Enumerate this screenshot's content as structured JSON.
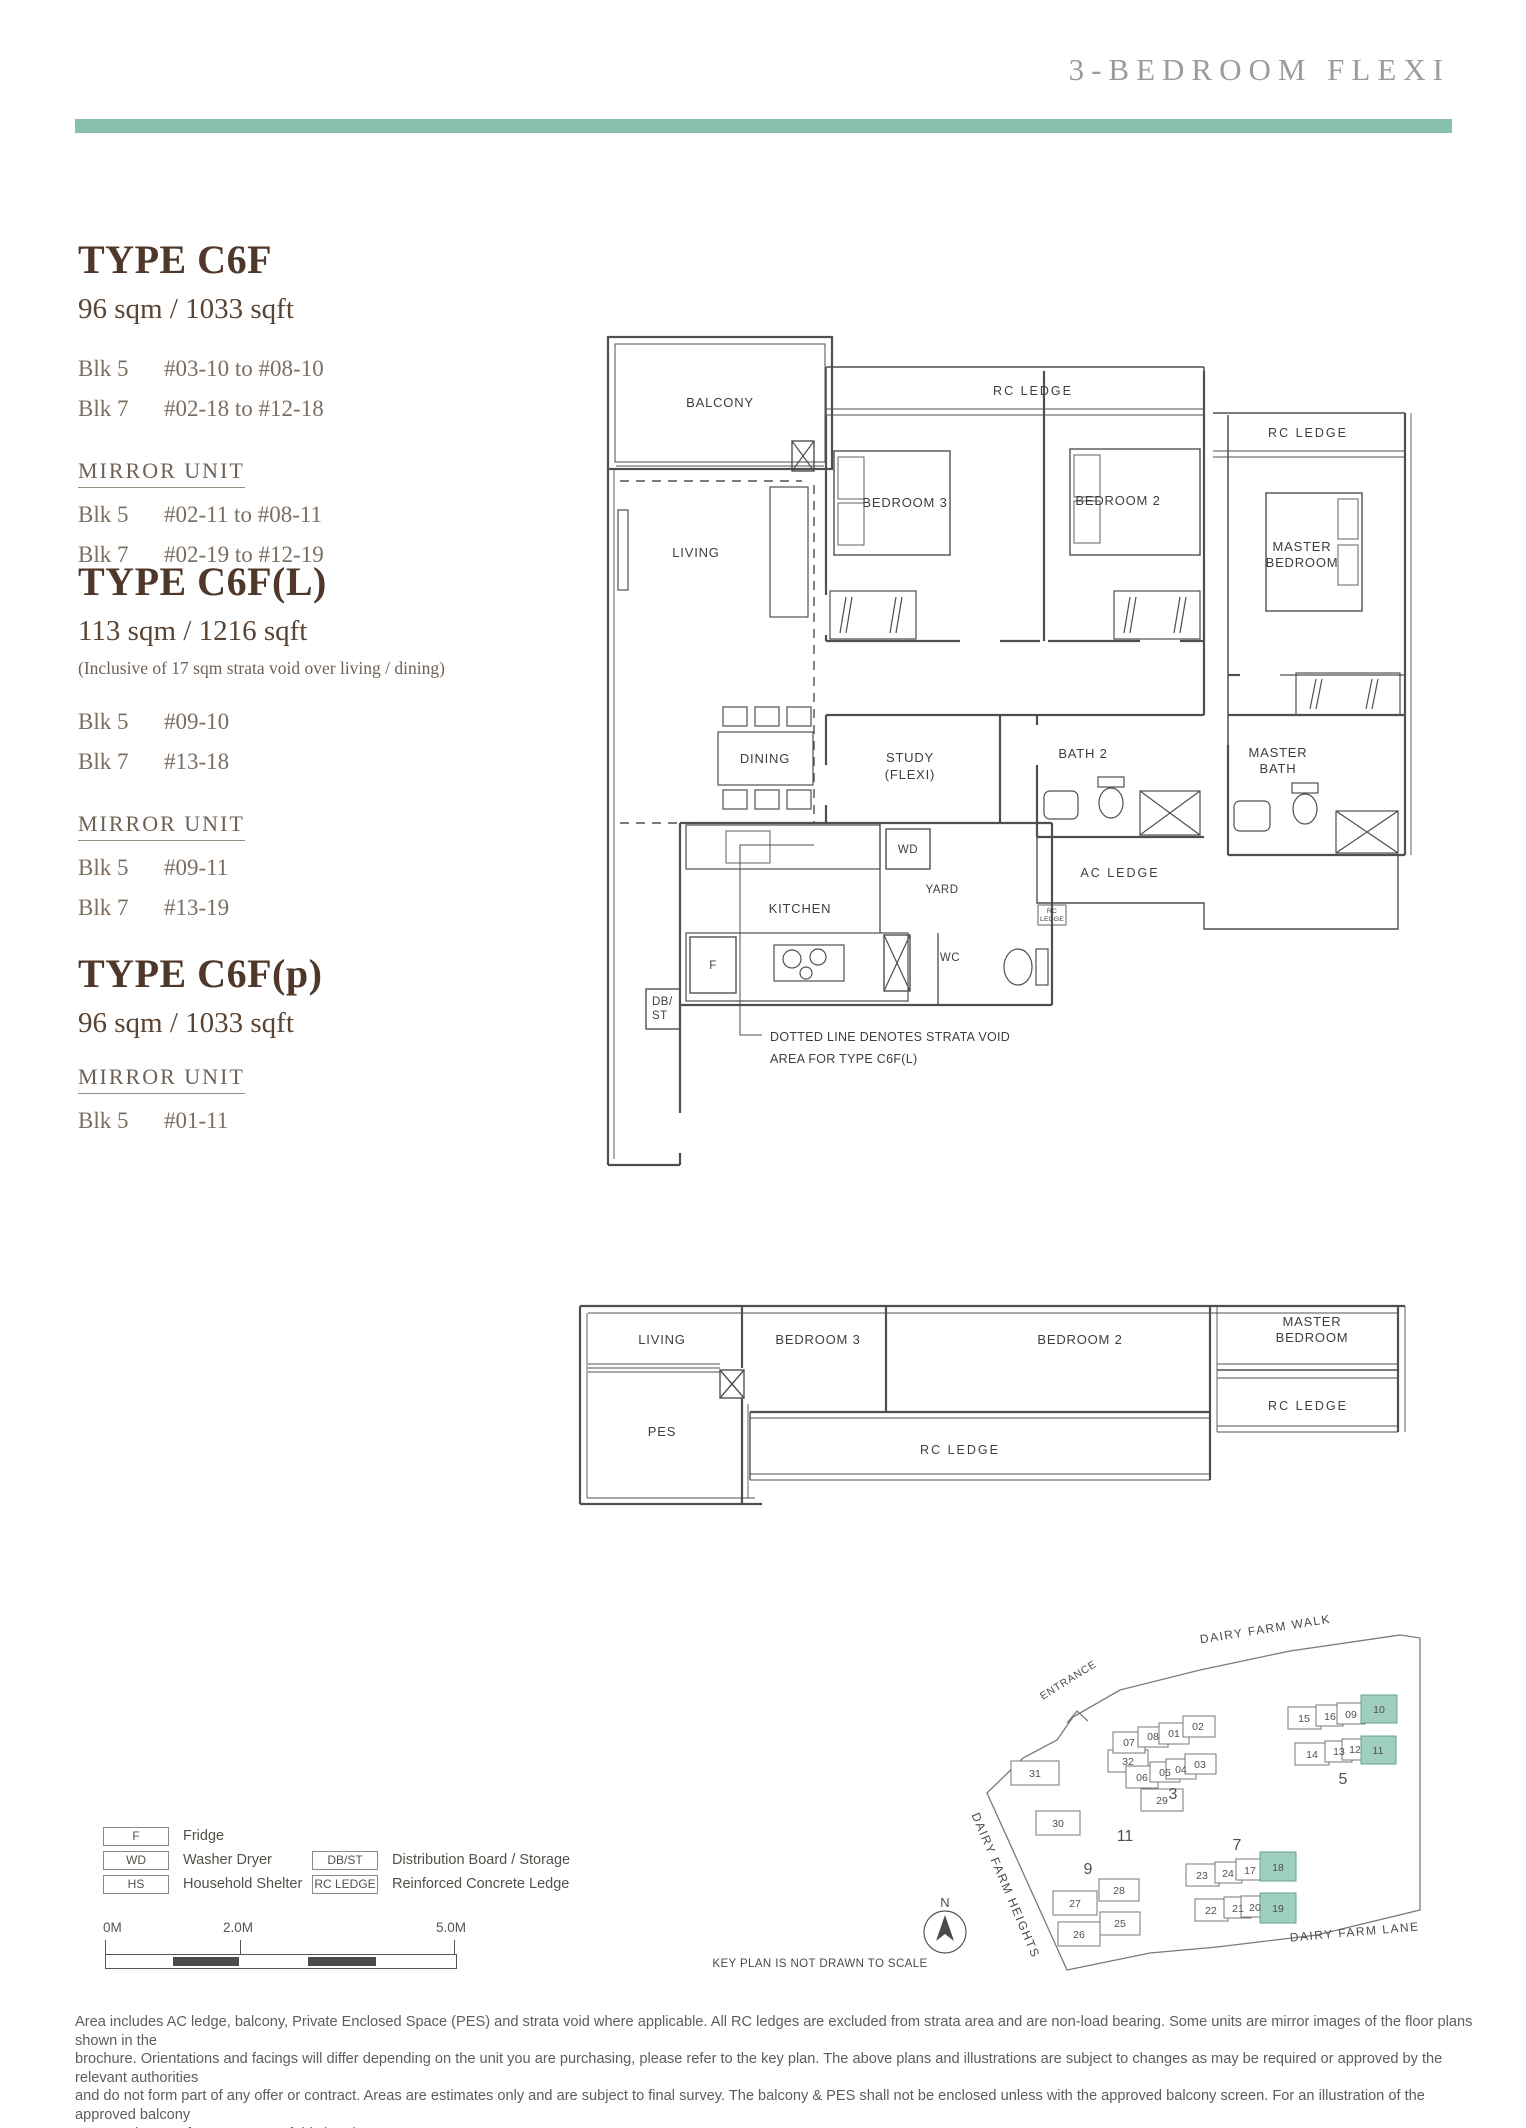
{
  "header": {
    "title": "3-BEDROOM FLEXI"
  },
  "accent_color": "#87c1ac",
  "types": [
    {
      "name": "TYPE C6F",
      "area": "96 sqm / 1033 sqft",
      "note": "",
      "units": [
        {
          "blk": "Blk 5",
          "range": "#03-10 to #08-10"
        },
        {
          "blk": "Blk 7",
          "range": "#02-18 to #12-18"
        }
      ],
      "mirror_label": "MIRROR UNIT",
      "mirror_units": [
        {
          "blk": "Blk 5",
          "range": "#02-11 to #08-11"
        },
        {
          "blk": "Blk 7",
          "range": "#02-19 to #12-19"
        }
      ]
    },
    {
      "name": "TYPE C6F(L)",
      "area": "113 sqm / 1216 sqft",
      "note": "(Inclusive of 17 sqm strata void over living / dining)",
      "units": [
        {
          "blk": "Blk 5",
          "range": "#09-10"
        },
        {
          "blk": "Blk 7",
          "range": "#13-18"
        }
      ],
      "mirror_label": "MIRROR UNIT",
      "mirror_units": [
        {
          "blk": "Blk 5",
          "range": "#09-11"
        },
        {
          "blk": "Blk 7",
          "range": "#13-19"
        }
      ]
    },
    {
      "name": "TYPE C6F(p)",
      "area": "96 sqm / 1033 sqft",
      "note": "",
      "units": [],
      "mirror_label": "MIRROR UNIT",
      "mirror_units": [
        {
          "blk": "Blk 5",
          "range": "#01-11"
        }
      ]
    }
  ],
  "plan1": {
    "balcony": "BALCONY",
    "living": "LIVING",
    "dining": "DINING",
    "study1": "STUDY",
    "study2": "(FLEXI)",
    "kitchen": "KITCHEN",
    "yard": "YARD",
    "wc": "WC",
    "wd": "WD",
    "fridge": "F",
    "dbst1": "DB/",
    "dbst2": "ST",
    "bedroom3": "BEDROOM 3",
    "bedroom2": "BEDROOM 2",
    "master1": "MASTER",
    "master2": "BEDROOM",
    "bath2": "BATH 2",
    "mbath1": "MASTER",
    "mbath2": "BATH",
    "rc_ledge1": "RC LEDGE",
    "rc_ledge2": "RC LEDGE",
    "rc_small1": "RC",
    "rc_small2": "LEDGE",
    "ac_ledge": "AC LEDGE",
    "note1": "DOTTED LINE DENOTES STRATA VOID",
    "note2": "AREA FOR TYPE C6F(L)"
  },
  "plan2": {
    "living": "LIVING",
    "pes": "PES",
    "bedroom3": "BEDROOM 3",
    "bedroom2": "BEDROOM 2",
    "master1": "MASTER",
    "master2": "BEDROOM",
    "rc_ledge1": "RC LEDGE",
    "rc_ledge2": "RC LEDGE"
  },
  "legend": {
    "items": [
      {
        "code": "F",
        "desc": "Fridge"
      },
      {
        "code": "WD",
        "desc": "Washer Dryer"
      },
      {
        "code": "HS",
        "desc": "Household Shelter"
      },
      {
        "code": "DB/ST",
        "desc": "Distribution Board / Storage"
      },
      {
        "code": "RC LEDGE",
        "desc": "Reinforced Concrete Ledge"
      }
    ]
  },
  "scalebar": {
    "ticks": [
      "0M",
      "2.0M",
      "5.0M"
    ]
  },
  "keyplan": {
    "highlight_color": "#9fd0bf",
    "streets": {
      "walk": "DAIRY FARM WALK",
      "heights": "DAIRY FARM HEIGHTS",
      "lane": "DAIRY FARM LANE"
    },
    "entrance": "ENTRANCE",
    "north": "N",
    "caption": "KEY PLAN IS NOT DRAWN TO SCALE",
    "blocks": [
      {
        "label": "11",
        "units": [
          "31",
          "32",
          "30",
          "29"
        ]
      },
      {
        "label": "3",
        "units": [
          "07",
          "08",
          "01",
          "02",
          "06",
          "05",
          "04",
          "03"
        ]
      },
      {
        "label": "5",
        "units": [
          "15",
          "16",
          "09",
          "10",
          "14",
          "13",
          "12",
          "11"
        ]
      },
      {
        "label": "7",
        "units": [
          "23",
          "24",
          "17",
          "18",
          "22",
          "21",
          "20",
          "19"
        ]
      },
      {
        "label": "9",
        "units": [
          "27",
          "28",
          "26",
          "25"
        ]
      }
    ]
  },
  "footer": {
    "lines": [
      "Area includes AC ledge, balcony, Private Enclosed Space (PES) and strata void where applicable. All RC ledges are excluded from strata area and are non-load bearing. Some units are mirror images of the floor plans shown in the",
      "brochure. Orientations and facings will differ depending on the unit you are purchasing, please refer to the key plan. The above plans and illustrations are subject to changes as may be required or approved by the relevant authorities",
      "and do not form part of any offer or contract. Areas are estimates only and are subject to final survey. The balcony & PES shall not be enclosed unless with the approved balcony screen. For an illustration of the approved balcony",
      "screen, please refer to Annex 1 of this brochure."
    ]
  }
}
